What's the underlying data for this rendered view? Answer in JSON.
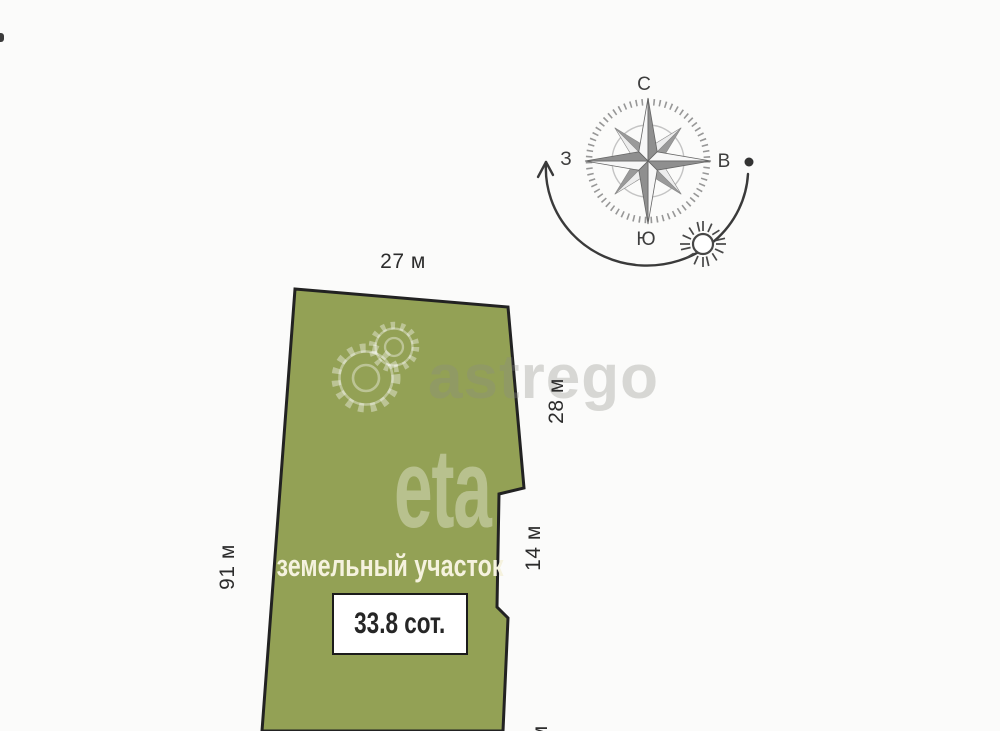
{
  "plot": {
    "label": "земельный участок",
    "area_value": "33.8 сот.",
    "fill_color": "#93a155",
    "outline_color": "#222222"
  },
  "dimensions": {
    "top": "27 м",
    "right_upper": "28 м",
    "right_mid": "14 м",
    "left": "91 м",
    "bottom_partial": "1 м"
  },
  "compass": {
    "north_label": "С",
    "east_label": "В",
    "south_label": "Ю",
    "west_label": "З"
  },
  "watermarks": {
    "primary": "astrego",
    "secondary": "eta"
  }
}
